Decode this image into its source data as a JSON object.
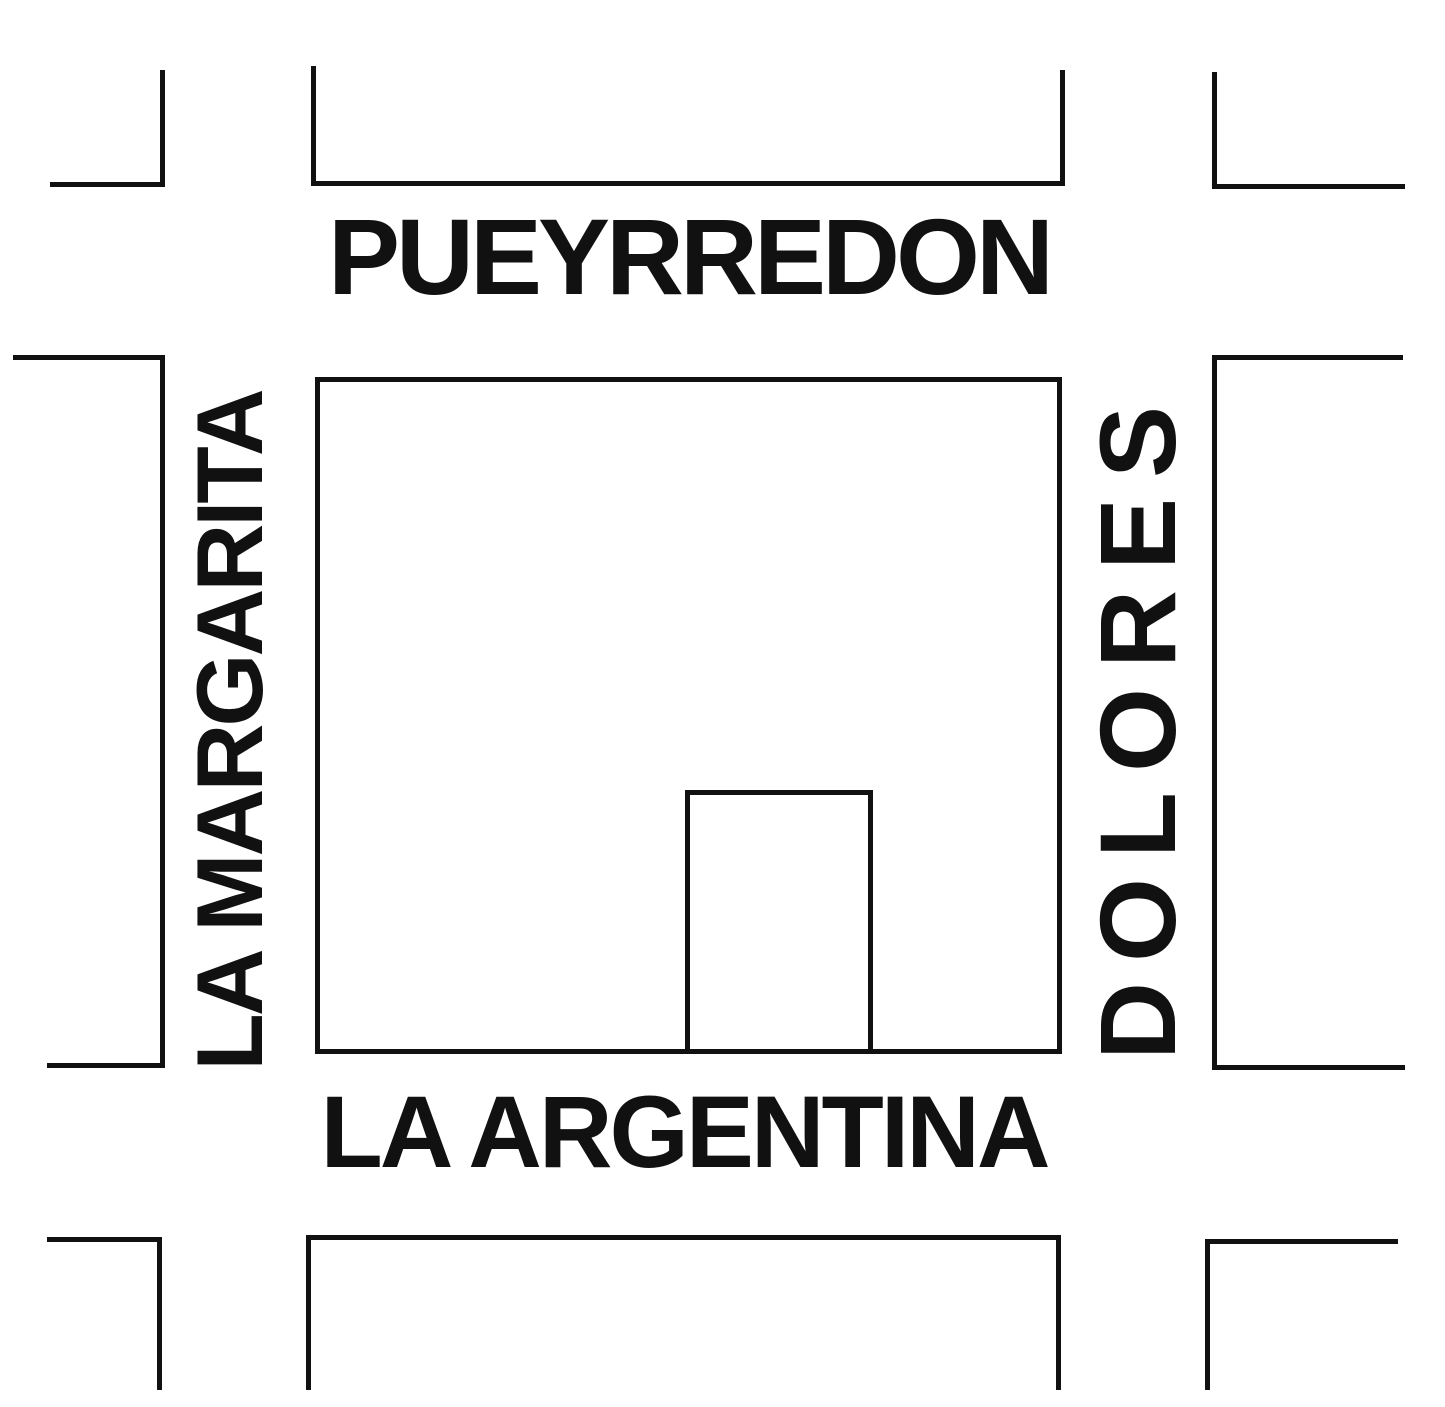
{
  "map": {
    "background_color": "#ffffff",
    "line_color": "#111111",
    "streets": {
      "top": "PUEYRREDON",
      "bottom": "LA ARGENTINA",
      "left": "LA MARGARITA",
      "right": "DOLORES"
    },
    "features": {
      "central_block": "city block bounded by the four streets",
      "building_lot": "small rectangular lot on the south edge of the central block"
    }
  }
}
